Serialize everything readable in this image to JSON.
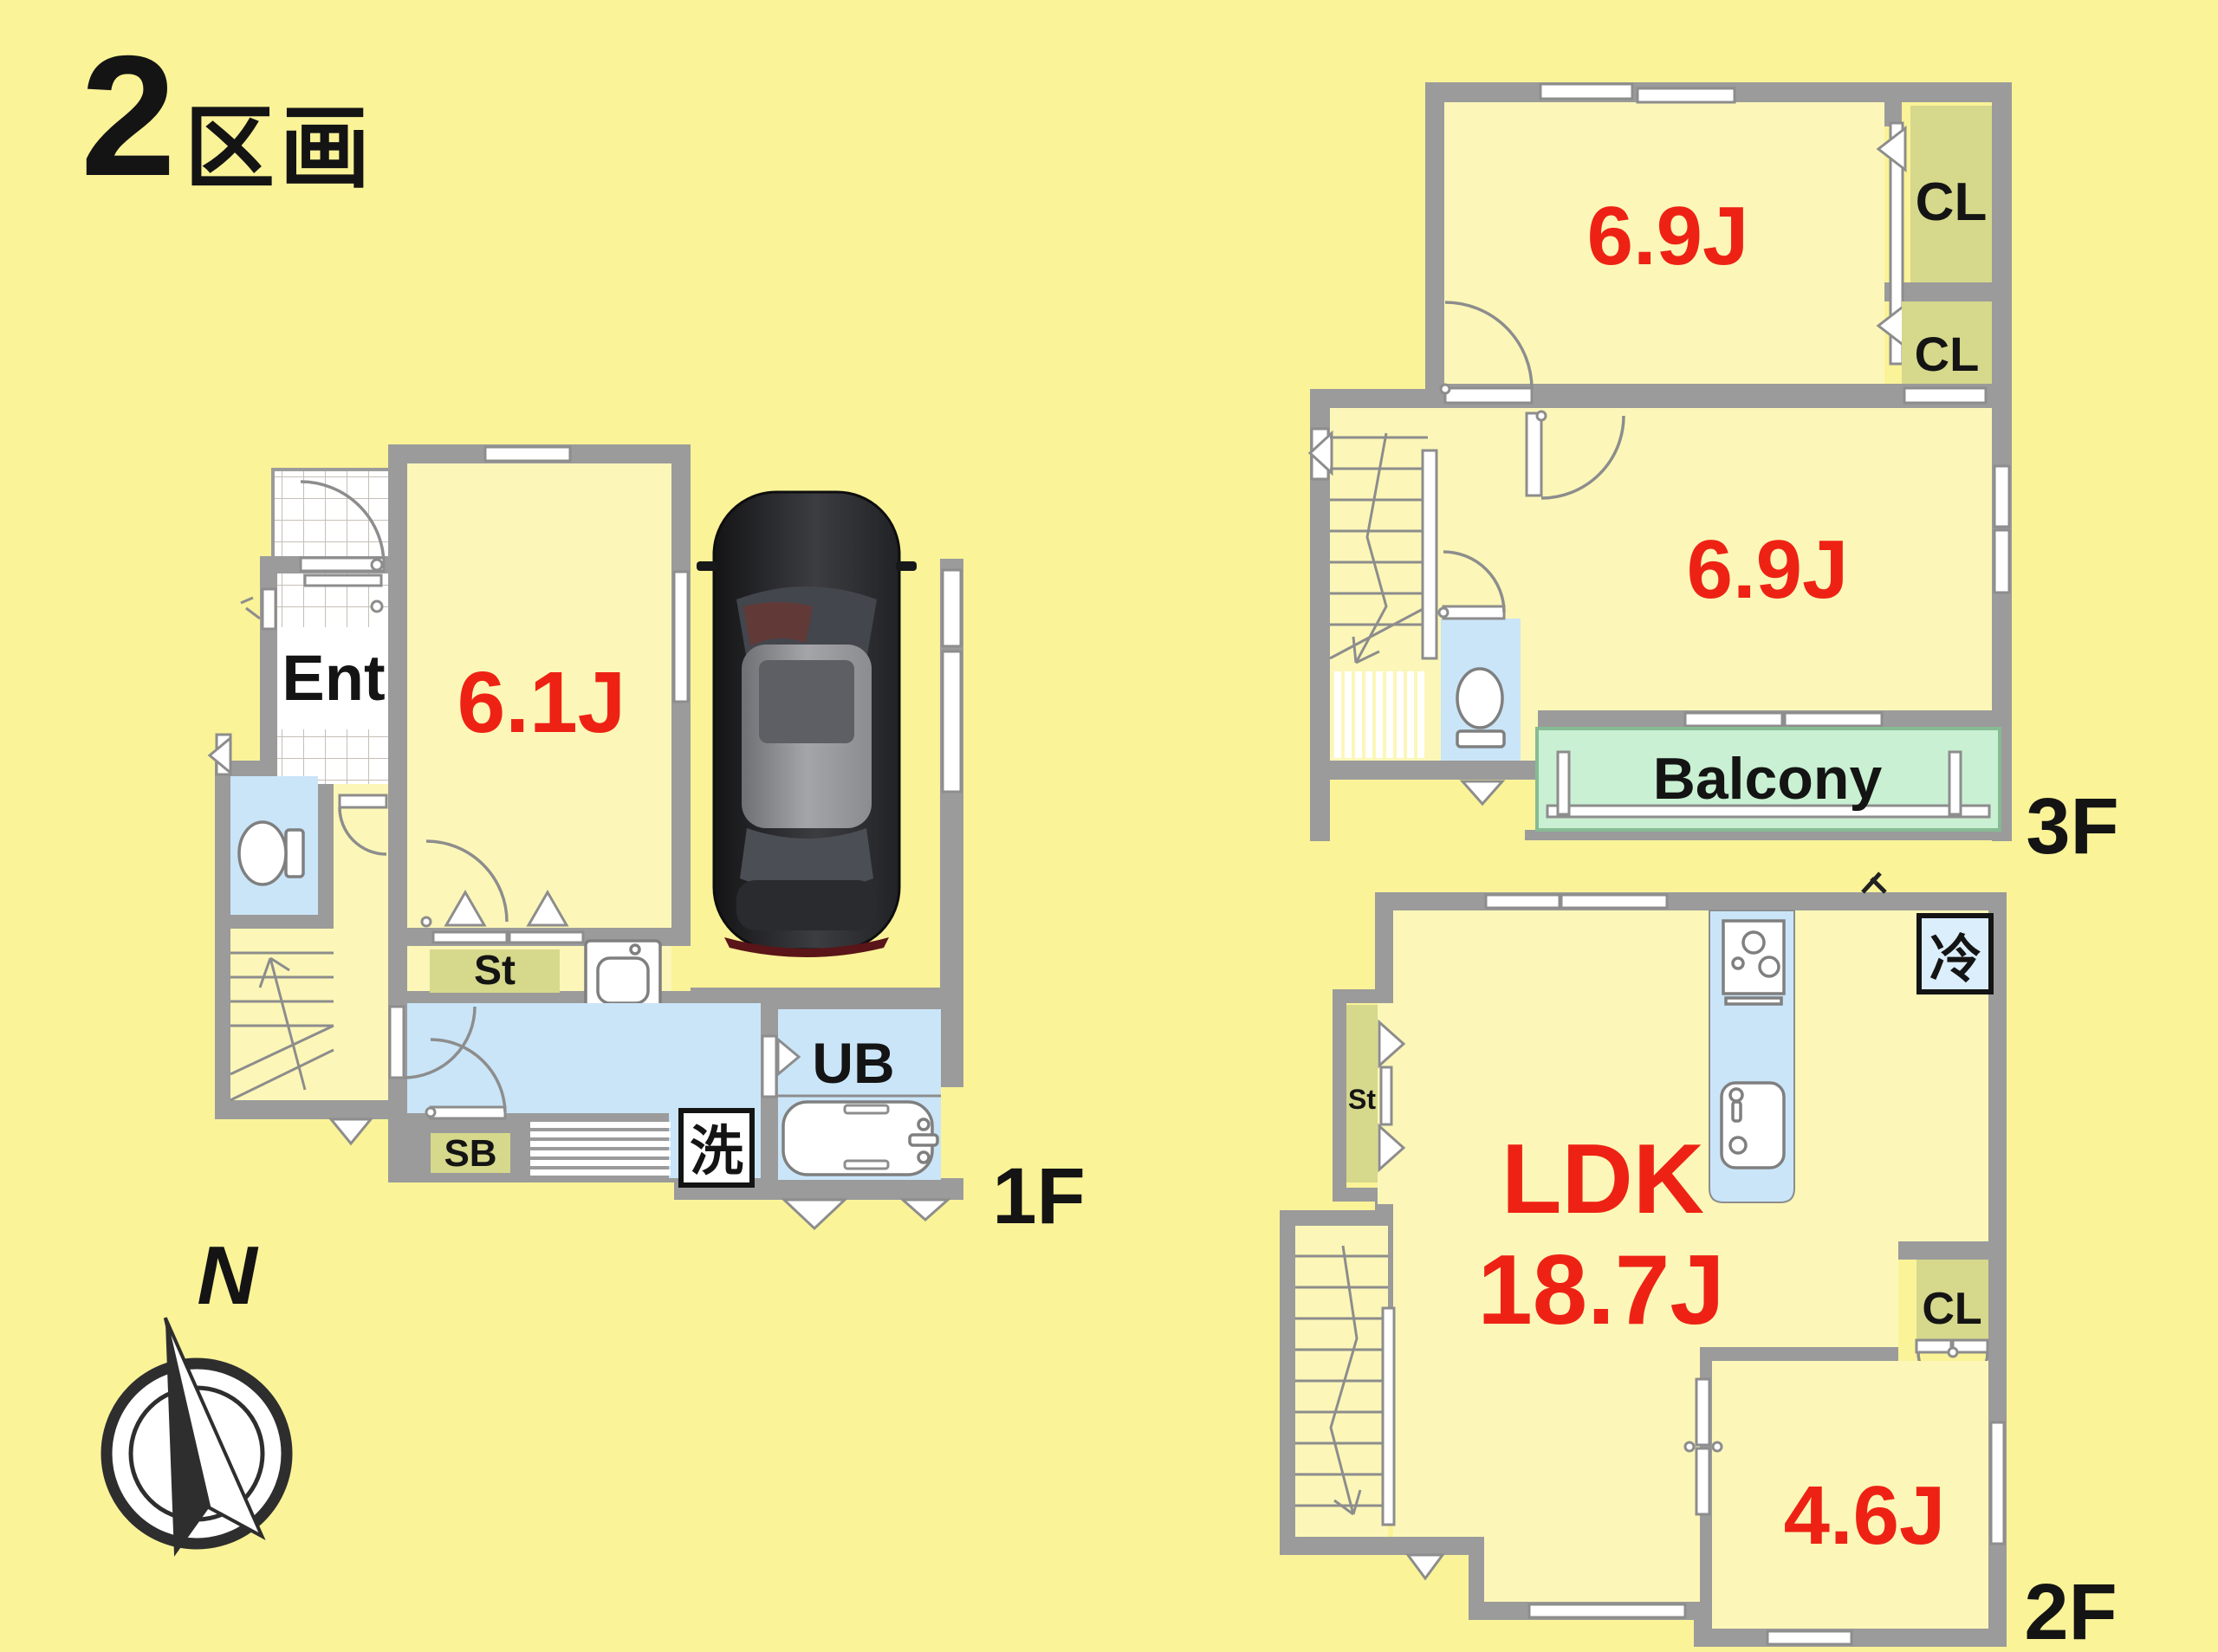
{
  "title": {
    "number": "2",
    "suffix": "区画"
  },
  "compass": {
    "north_label": "N"
  },
  "colors": {
    "background": "#faf398",
    "room_fill": "#fcf7b8",
    "wall_gray": "#9b9b9b",
    "water_blue": "#cae5f8",
    "storage_olive": "#d6d88c",
    "balcony_green": "#c9f0d2",
    "size_label_red": "#ee2214",
    "text_black": "#141414"
  },
  "floor_1f": {
    "label": "1F",
    "rooms": {
      "entrance": "Ent",
      "western_room": "6.1J",
      "storage": "St",
      "shoe_box": "SB",
      "unit_bath": "UB",
      "laundry": "洗"
    }
  },
  "floor_3f": {
    "label": "3F",
    "rooms": {
      "western_room_1": "6.9J",
      "closet_1": "CL",
      "closet_2": "CL",
      "western_room_2": "6.9J",
      "balcony": "Balcony"
    }
  },
  "floor_2f": {
    "label": "2F",
    "rooms": {
      "ldk_name": "LDK",
      "ldk_size": "18.7J",
      "refrigerator": "冷",
      "storage": "St",
      "closet": "CL",
      "western_room": "4.6J"
    }
  }
}
